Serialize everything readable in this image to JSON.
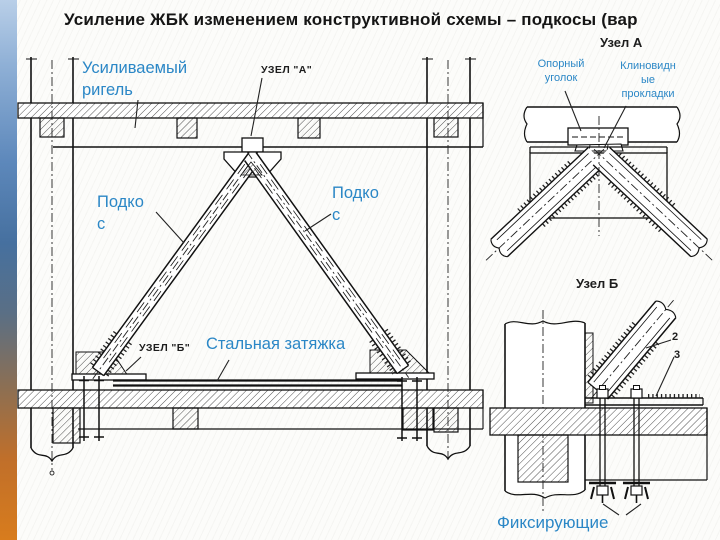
{
  "colors": {
    "label_blue": "#2b87c6",
    "line_black": "#1a1a1a",
    "accent_bar_top": "#b9cfe8",
    "accent_bar_middle": "#46709f",
    "accent_bar_bottom": "#d87c1d"
  },
  "slide": {
    "title": "Усиление ЖБК изменением конструктивной схемы – подкосы (вар"
  },
  "headings": {
    "node_a": "Узел А",
    "node_b": "Узел Б"
  },
  "main_diagram": {
    "girder_label_line1": "Усиливаемый",
    "girder_label_line2": "ригель",
    "node_a_callout": "УЗЕЛ \"А\"",
    "strut_left_line1": "Подко",
    "strut_left_line2": "с",
    "strut_right_line1": "Подко",
    "strut_right_line2": "с",
    "node_b_callout": "УЗЕЛ \"Б\"",
    "tie_label": "Стальная затяжка"
  },
  "node_a_detail": {
    "support_angle_line1": "Опорный",
    "support_angle_line2": "уголок",
    "wedge_line1": "Клиновидн",
    "wedge_line2": "ые",
    "wedge_line3": "прокладки"
  },
  "node_b_detail": {
    "callout_2": "2",
    "callout_3": "3",
    "fixing_label": "Фиксирующие"
  }
}
